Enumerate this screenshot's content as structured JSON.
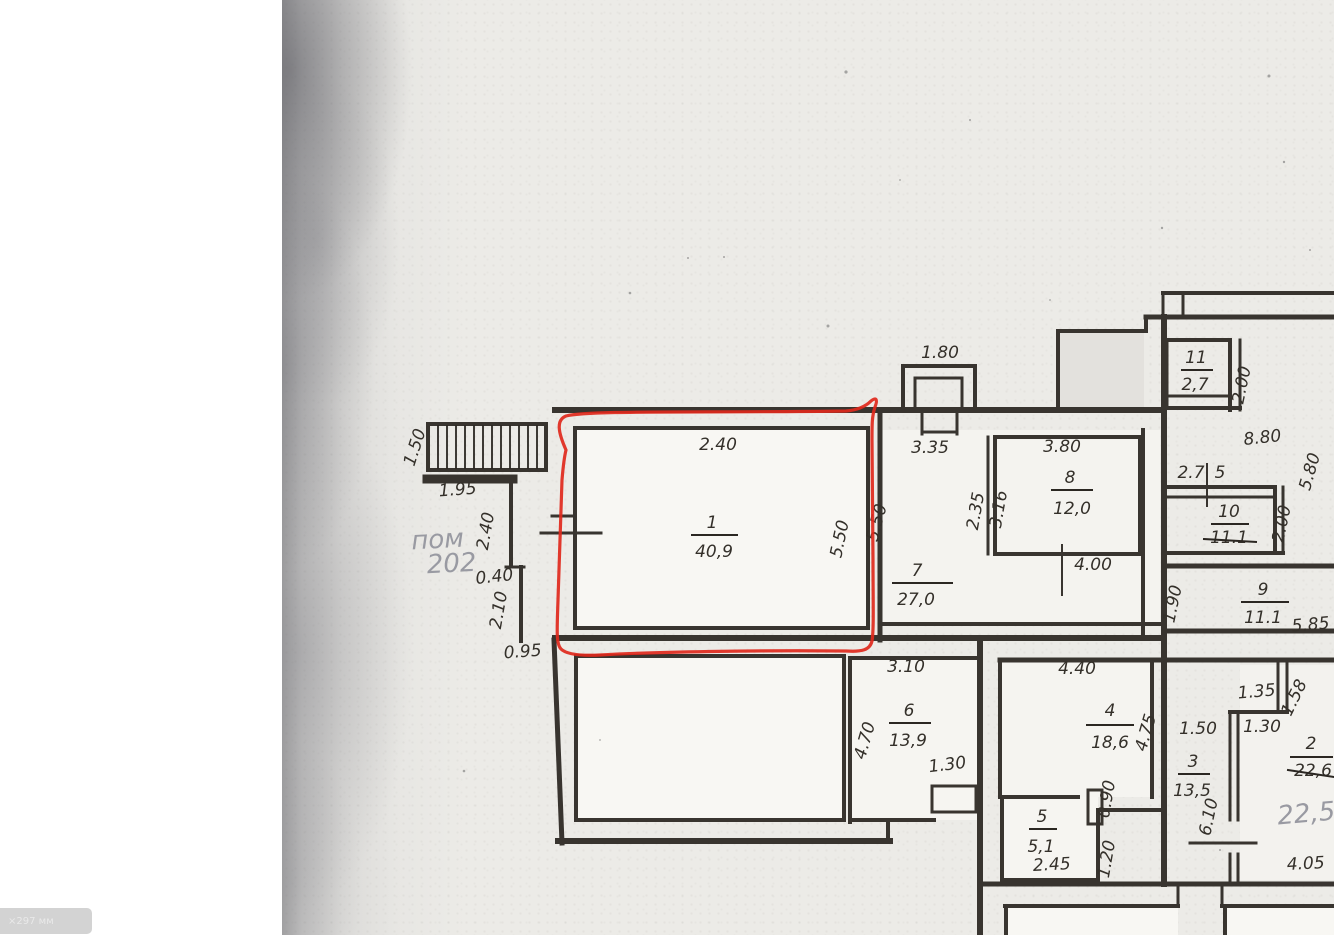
{
  "scan": {
    "corner_badge_text": "×297 мм"
  },
  "pencil_notes": {
    "room_note_line1": "пом",
    "room_note_line2": "202"
  },
  "floor_plan": {
    "rooms": [
      {
        "number": "1",
        "area": "40,9"
      },
      {
        "number": "2",
        "area_crossed_out": "22,6",
        "area_pencil": "22,5"
      },
      {
        "number": "3",
        "area": "13,5"
      },
      {
        "number": "4",
        "area": "18,6"
      },
      {
        "number": "5",
        "area": "5,1"
      },
      {
        "number": "6",
        "area": "13,9"
      },
      {
        "number": "7",
        "area": "27,0"
      },
      {
        "number": "8",
        "area": "12,0"
      },
      {
        "number": "9",
        "area": "11.1"
      },
      {
        "number": "10",
        "area_crossed_out": "11.1"
      },
      {
        "number": "11",
        "area": "2,7"
      }
    ],
    "dimensions": {
      "d180": "1.80",
      "d240_top": "2.40",
      "d550_a": "5.50",
      "d550_b": "5.50",
      "d335": "3.35",
      "d380": "3.80",
      "d235": "2.35",
      "d316": "3.16",
      "d400": "4.00",
      "d150_stairs": "1.50",
      "d195": "1.95",
      "d240_left": "2.40",
      "d040": "0.40",
      "d210": "2.10",
      "d095": "0.95",
      "d200_a": "2.00",
      "d880": "8.80",
      "d580": "5.80",
      "d27": "2.7",
      "d5": "5",
      "d200_b": "2.00",
      "d190": "1.90",
      "d585": "5.85",
      "d310": "3.10",
      "d470": "4.70",
      "d130_a": "1.30",
      "d440": "4.40",
      "d475": "4.75",
      "d090": "0.90",
      "d120": "1.20",
      "d245": "2.45",
      "d135": "1.35",
      "d158": "1.58",
      "d150_b": "1.50",
      "d130_b": "1.30",
      "d610": "6.10",
      "d405": "4.05"
    }
  },
  "colors": {
    "ink": "#2b2722",
    "pencil": "#999aa2",
    "red_marker": "#e0281c",
    "paper": "#ecebe7"
  }
}
